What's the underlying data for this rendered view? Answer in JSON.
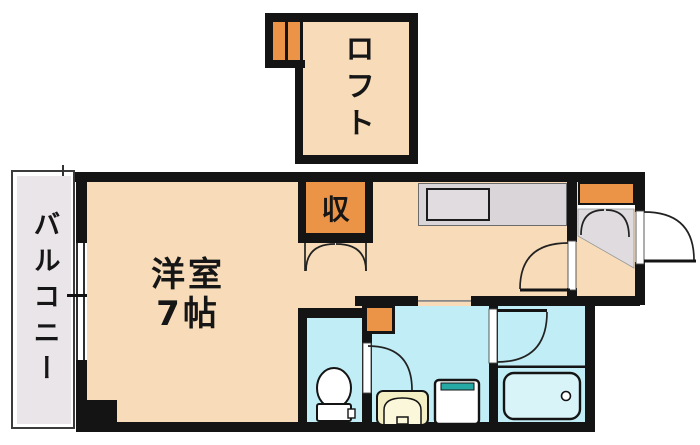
{
  "type": "floorplan",
  "rooms": {
    "balcony": {
      "label": "バルコニー"
    },
    "loft": {
      "label": "ロフト"
    },
    "main_room": {
      "label": "洋室7帖",
      "label_line1": "洋室",
      "label_line2": "7帖",
      "size_tatami": 7
    },
    "closet": {
      "label": "収"
    }
  },
  "fixtures": [
    "loft-ladder",
    "kitchen-counter",
    "kitchen-sink",
    "closet-folding-doors",
    "shoe-cabinet",
    "genkan-tile",
    "entrance-door",
    "room-entry-door",
    "toilet",
    "toilet-door",
    "washroom-cabinet",
    "washbasin",
    "washing-machine-pan",
    "bathroom-door",
    "bathtub",
    "balcony-window"
  ],
  "colors": {
    "floor": "#F8DCB9",
    "orange": "#EB9347",
    "wet": "#C1EDF6",
    "tub": "#D9F4F9",
    "balconyGray": "#E9E5E9",
    "tileGray": "#DFDBDF",
    "counterGray": "#D9D5D9",
    "wall": "#141414",
    "basin": "#F3EEC3",
    "teal": "#26A8A4"
  }
}
